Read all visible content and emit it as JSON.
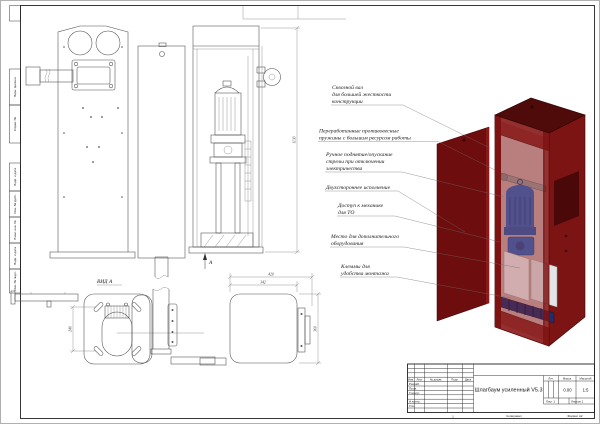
{
  "document": {
    "type": "engineering-drawing",
    "standard": "GOST",
    "sheet_format": "A2"
  },
  "colors": {
    "paper": "#ffffff",
    "line": "#4a4a4a",
    "door_red": "#6e0d0d",
    "cabinet_red": "#7d1414",
    "cabinet_dark": "#4f0a0a",
    "motor_blue": "#2f66c0",
    "terminal_blue": "#1e2f6e",
    "panel_white": "#eceef0"
  },
  "views": {
    "view_a_label": "ВИД А",
    "arrow_label": "А"
  },
  "dims": {
    "cabinet_height": "1130",
    "base_slots": "240",
    "width_outer": "420",
    "width_inner": "342",
    "depth": "360"
  },
  "annotations": [
    {
      "lines": [
        "Сквозной вал",
        "для большей жесткости",
        "конструкции"
      ]
    },
    {
      "lines": [
        "Переработанные противовесные",
        "пружины с большим ресурсом работы"
      ]
    },
    {
      "lines": [
        "Ручное поднятие/опускание",
        "стрелы при отключении",
        "электричества"
      ]
    },
    {
      "lines": [
        "Двухстороннее исполнение"
      ]
    },
    {
      "lines": [
        "Доступ к механике",
        "для ТО"
      ]
    },
    {
      "lines": [
        "Место для дополнительного",
        "оборудования"
      ]
    },
    {
      "lines": [
        "Клеммы для",
        "удобства монтажа"
      ]
    }
  ],
  "frame": {
    "left_labels": [
      "Перв. примен.",
      "Справ. №",
      "Подп. и дата",
      "Инв. № дубл.",
      "Взам. инв. №",
      "Подп. и дата",
      "Инв. № подл."
    ]
  },
  "title_block": {
    "title": "Шлагбаум усиленный V5.3",
    "columns": [
      "Изм.",
      "Лист",
      "№ докум.",
      "Подп.",
      "Дата"
    ],
    "rows": [
      "Разраб.",
      "Пров.",
      "Т.контр.",
      "Н.контр.",
      "Утв."
    ],
    "lit_label": "Лит.",
    "mass_label": "Масса",
    "scale_label": "Масштаб",
    "mass_value": "0.00",
    "scale_value": "1:5",
    "sheet": "Лист 1",
    "sheets": "Листов 1",
    "copied": "Копировал",
    "format": "Формат А2",
    "fold_mark": "1"
  }
}
